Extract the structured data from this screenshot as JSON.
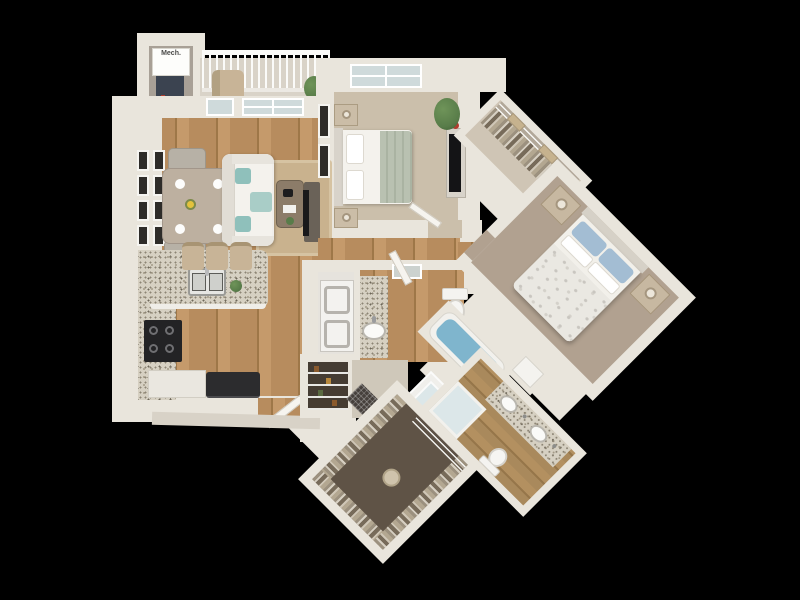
{
  "labels": {
    "mech": "Mech."
  },
  "palette": {
    "bg": "#000000",
    "wall": "#e9e5dc",
    "wallShade": "#d3cdc1",
    "wood": "#b78c5e",
    "woodDark": "#9e7748",
    "carpetA": "#cbbfab",
    "carpetB": "#b1a190",
    "graniteBase": "#d6d0c2",
    "rug": "#c9b28e",
    "sofa": "#f0eeea",
    "teal": "#8fc0bb",
    "tubWater": "#7fb5cd",
    "glass": "#dce7e9",
    "appliance": "#232325",
    "closetFloor": "#5f5346",
    "plant": "#587c49",
    "tan": "#c8b497",
    "laundry": "#f3f2ef",
    "windowPane": "#cfdadb",
    "accentRed": "#b23c2e"
  }
}
